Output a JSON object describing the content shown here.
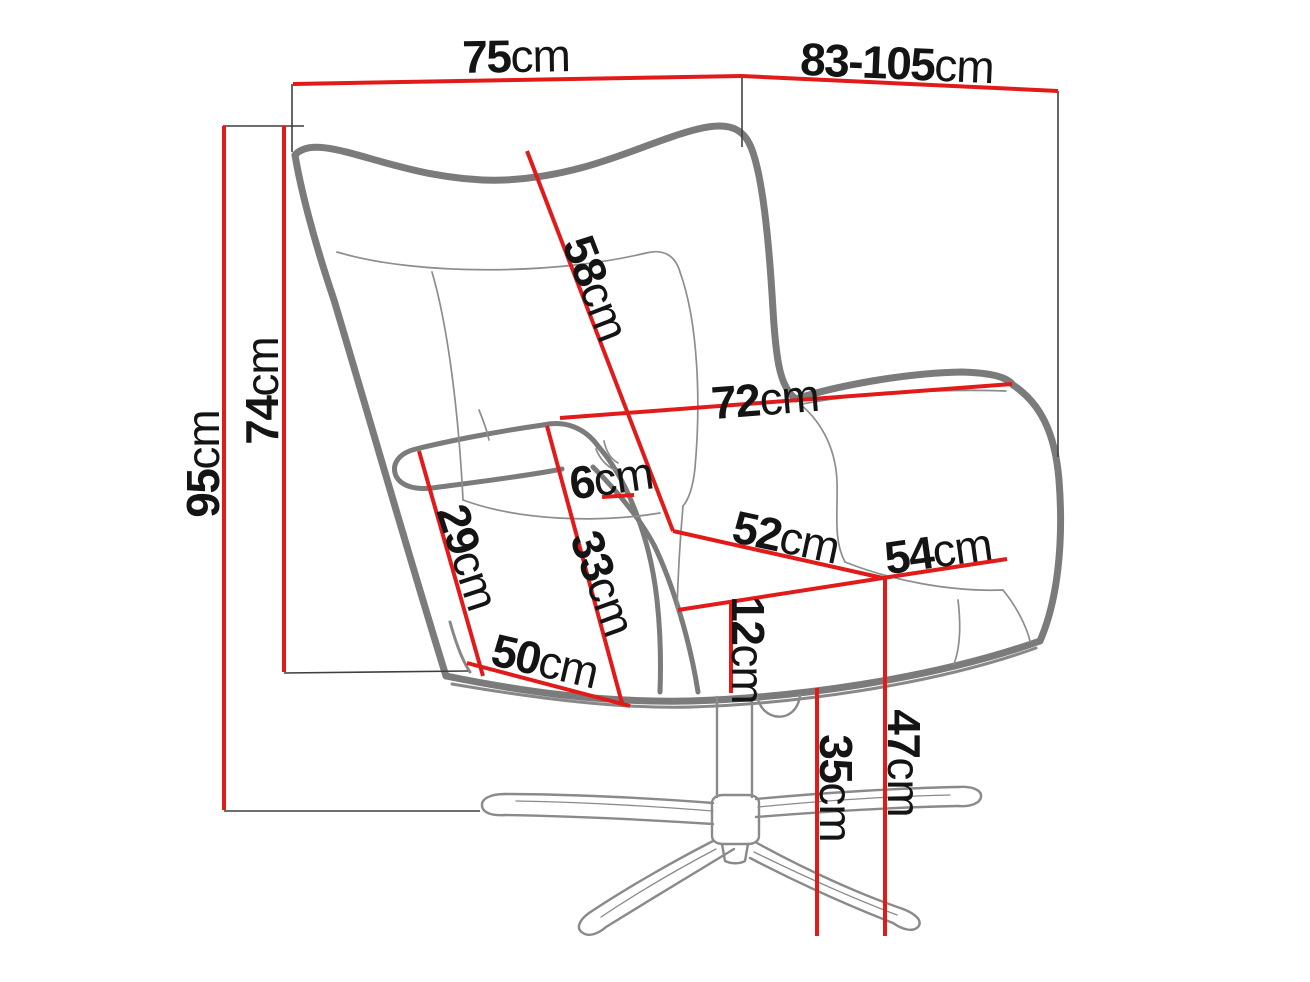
{
  "diagram": {
    "kind": "furniture-dimension-diagram",
    "subject": "wingback swivel armchair line drawing with dimension lines",
    "unit": "cm",
    "colors": {
      "dimension": "#e11a1a",
      "outline": "#7b7b7b",
      "outline_shadow": "#606060",
      "seam": "#8d8d8d",
      "base": "#8a8a8a",
      "helper": "#3f3f3f",
      "text": "#141414",
      "background": "#ffffff"
    },
    "labels": {
      "d75": {
        "value": "75",
        "unit": "cm"
      },
      "d83": {
        "value": "83-105",
        "unit": "cm"
      },
      "d95": {
        "value": "95",
        "unit": "cm"
      },
      "d74": {
        "value": "74",
        "unit": "cm"
      },
      "d58": {
        "value": "58",
        "unit": "cm"
      },
      "d72": {
        "value": "72",
        "unit": "cm"
      },
      "d6": {
        "value": "6",
        "unit": "cm"
      },
      "d33": {
        "value": "33",
        "unit": "cm"
      },
      "d29": {
        "value": "29",
        "unit": "cm"
      },
      "d50": {
        "value": "50",
        "unit": "cm"
      },
      "d52": {
        "value": "52",
        "unit": "cm"
      },
      "d54": {
        "value": "54",
        "unit": "cm"
      },
      "d12": {
        "value": "12",
        "unit": "cm"
      },
      "d35": {
        "value": "35",
        "unit": "cm"
      },
      "d47": {
        "value": "47",
        "unit": "cm"
      }
    },
    "measurements_visible": [
      "75cm",
      "83-105cm",
      "95cm",
      "74cm",
      "58cm",
      "72cm",
      "6cm",
      "33cm",
      "29cm",
      "50cm",
      "52cm",
      "54cm",
      "12cm",
      "35cm",
      "47cm"
    ]
  }
}
